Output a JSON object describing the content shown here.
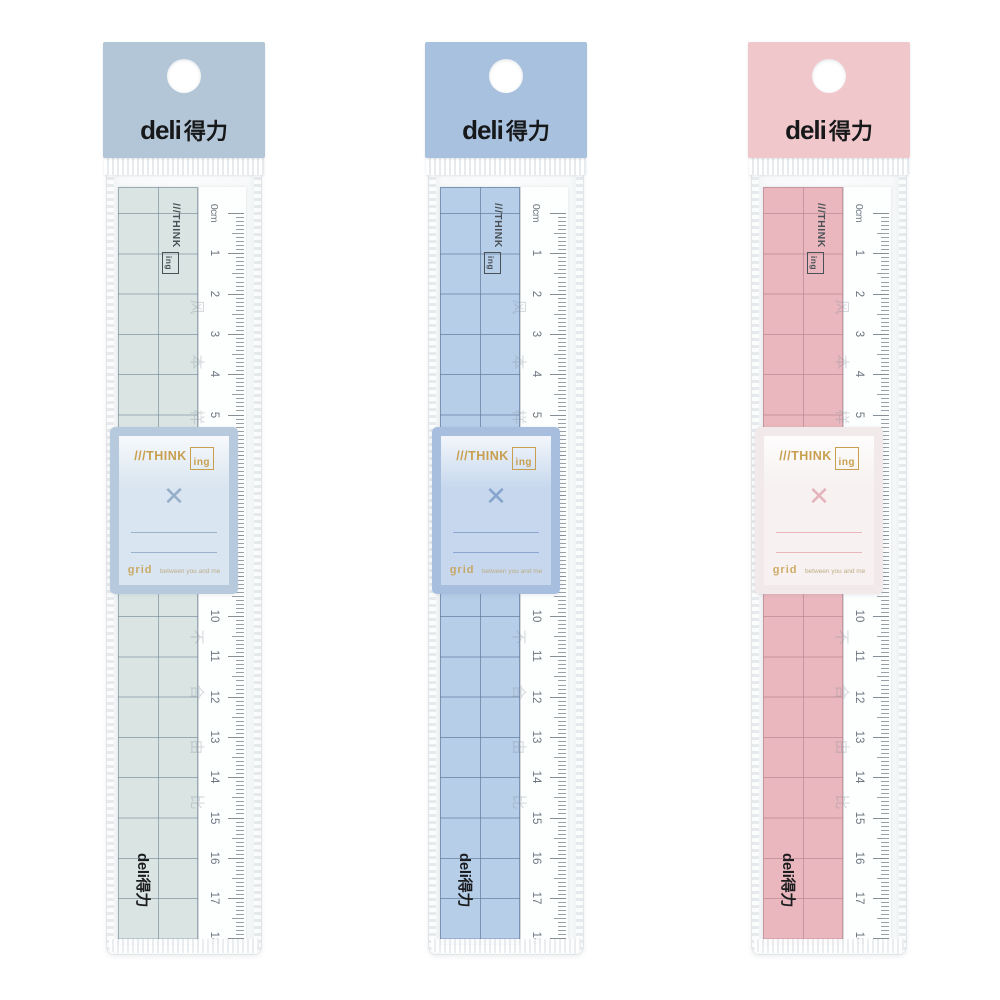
{
  "page": {
    "background": "#ffffff"
  },
  "shared": {
    "brand": {
      "latin": "deli",
      "cjk": "得力"
    },
    "ruler": {
      "numbers": [
        "0cm",
        "1",
        "2",
        "3",
        "4",
        "5",
        "6",
        "7",
        "8",
        "9",
        "10",
        "11",
        "12",
        "13",
        "14",
        "15",
        "16",
        "17",
        "18"
      ],
      "think_prefix": "///THINK",
      "think_suffix": "ing",
      "watermark_chars": [
        "风",
        "本",
        "样",
        "高",
        "化",
        "器",
        "不",
        "合",
        "由",
        "比"
      ]
    },
    "card": {
      "think_prefix": "///THINK",
      "think_suffix": "ing",
      "tagline_lead": "grid",
      "tagline_rest": "between you and me",
      "x_glyph": "✕"
    },
    "bottom_logo": "deli得力",
    "gold": "#c79f4e"
  },
  "packages": [
    {
      "variant": "gray-green",
      "header_color": "#b3c6d8",
      "ruler_color": "#dae4e3",
      "grid_line": "#6f849499",
      "card_border": "#b6c9dd",
      "card_inner": "#d9e5f0",
      "accent": "#8aa6c4"
    },
    {
      "variant": "blue",
      "header_color": "#a8c1de",
      "ruler_color": "#b7cee9",
      "grid_line": "#5d7799aa",
      "card_border": "#a7bedf",
      "card_inner": "#c7d8ee",
      "accent": "#7b9cc7"
    },
    {
      "variant": "pink",
      "header_color": "#f0c8cc",
      "ruler_color": "#e9b7bd",
      "grid_line": "#b3808c99",
      "card_border": "#f2e9ea",
      "card_inner": "#f7f1f1",
      "accent": "#e3a9b2"
    }
  ]
}
